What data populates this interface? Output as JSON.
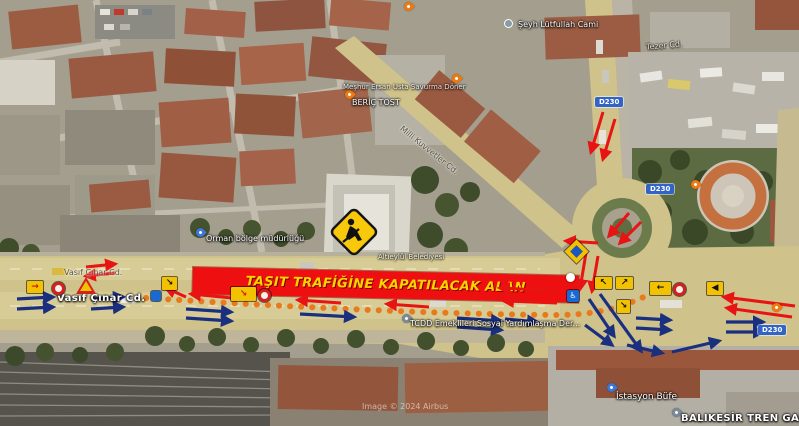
{
  "banner": {
    "text": "TAŞIT TRAFİĞİNE KAPATILACAK ALAN"
  },
  "shield": {
    "code": "D230"
  },
  "labels": {
    "mosque": "Şeyh Lütfullah Cami",
    "street_tezer": "Tezer Cd.",
    "street_milli": "Milli Kuvvetler Cd.",
    "poi_doner": "Meşhur Ersan Usta Savurma Döner",
    "poi_tost": "BERİÇ TOST",
    "poi_orman": "Orman bölge müdürlüğü",
    "poi_belediye": "Altıeylül Belediyesi",
    "street_vasif_upper": "Vasıf Çınar Cd.",
    "street_vasif_lower": "Vasıf Çınar Cd.",
    "poi_tcdd": "TCDD Emeklileri Sosyal Yardımlaşma Der...",
    "poi_bufe": "İstasyon Büfe",
    "poi_gar": "BALIKESİR TREN GAR",
    "watermark": "Image © 2024 Airbus"
  },
  "icons": {
    "arrow_ne": "↗",
    "arrow_nw": "↖",
    "arrow_se": "↘",
    "arrow_left": "←",
    "arrow_right_red": "→",
    "horn": "◀",
    "access": "♿"
  },
  "colors": {
    "closure_red": "#ee1010",
    "banner_text": "#ffd400",
    "route_dots": "#e87a1e",
    "arrow_red": "#e81313",
    "arrow_blue": "#1b2f7f",
    "sign_yellow": "#f2c200"
  }
}
